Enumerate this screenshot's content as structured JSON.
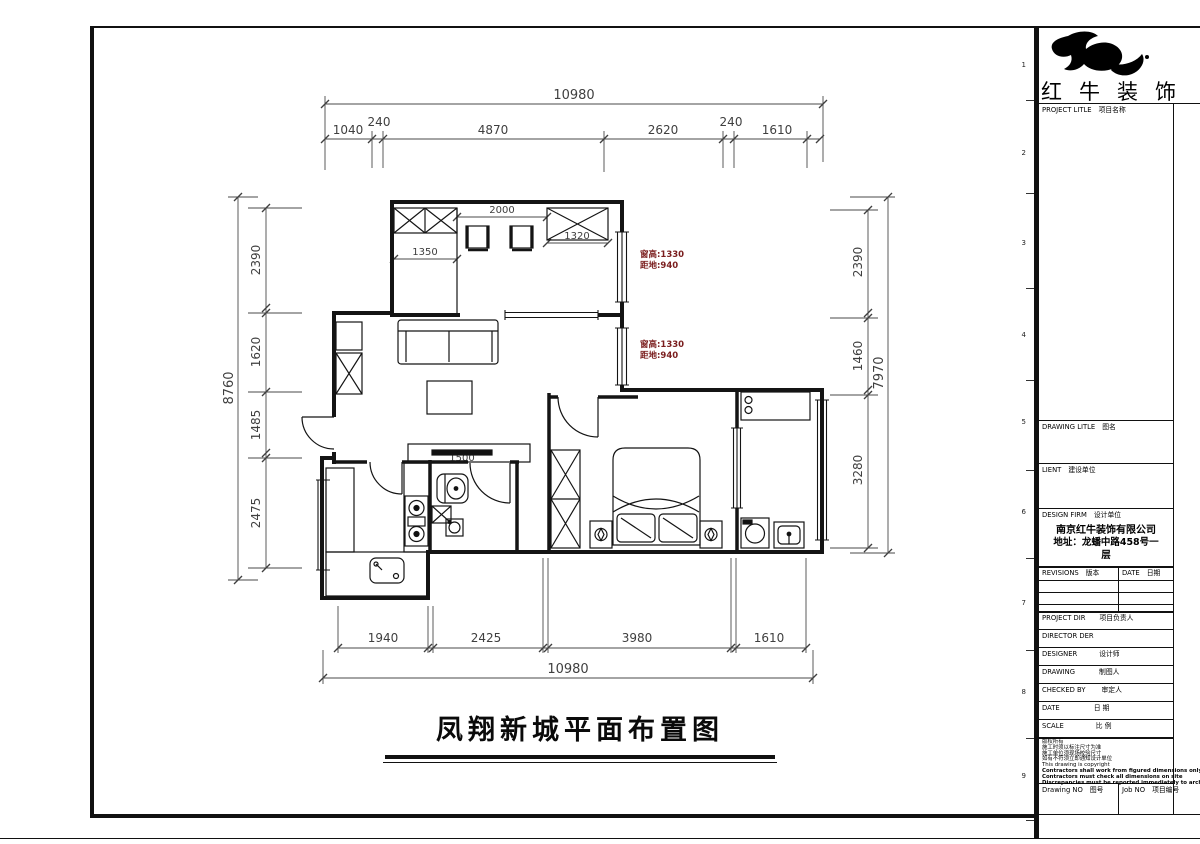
{
  "brand": {
    "name": "红牛装饰"
  },
  "row_markers": [
    "1",
    "2",
    "3",
    "4",
    "5",
    "6",
    "7",
    "8",
    "9"
  ],
  "title_block": {
    "project_title_en": "PROJECT LITLE",
    "project_title_cn": "项目名称",
    "drawing_title_en": "DRAWING LITLE",
    "drawing_title_cn": "图名",
    "client_en": "LIENT",
    "client_cn": "建设单位",
    "design_firm_en": "DESIGN FIRM",
    "design_firm_cn": "设计单位",
    "firm_name": "南京红牛装饰有限公司",
    "firm_address_line1": "地址：龙蟠中路458号一",
    "firm_address_line2": "层",
    "revisions_en": "REVISIONS",
    "revisions_cn": "版本",
    "date_en": "DATE",
    "date_cn": "日期",
    "rows": [
      {
        "en": "PROJECT DIR",
        "cn": "项目负责人"
      },
      {
        "en": "DIRECTOR DER",
        "cn": ""
      },
      {
        "en": "DESIGNER",
        "cn": "设计师"
      },
      {
        "en": "DRAWING",
        "cn": "制图人"
      },
      {
        "en": "CHECKED BY",
        "cn": "审定人"
      },
      {
        "en": "DATE",
        "cn": "日 期"
      },
      {
        "en": "SCALE",
        "cn": "比 例"
      }
    ],
    "notes": [
      "版权所有",
      "施工时须以标注尺寸为准",
      "施工单位须现场校验尺寸",
      "如有不符须立即通知设计单位",
      "This drawing is copyright",
      "Contractors shall work from figured dimensions only",
      "Contractors must check all dimensions on site",
      "Discrepancies must be reported immediately to architects"
    ],
    "drawing_no_en": "Drawing NO",
    "drawing_no_cn": "图号",
    "job_no_en": "Job NO",
    "job_no_cn": "项目编号"
  },
  "plan": {
    "title": "凤翔新城平面布置图",
    "colors": {
      "annotation_red": "#7a1d1d",
      "line_black": "#1a1a1a"
    },
    "window_notes": {
      "upper": {
        "line1": "窗高:1330",
        "line2": "距地:940"
      },
      "lower": {
        "line1": "窗高:1330",
        "line2": "距地:940"
      }
    },
    "inner_dims": {
      "wardrobe_gap": "2000",
      "closet": "1350",
      "wardrobe_right": "1320",
      "tv_cabinet": "1500"
    },
    "dims": {
      "top": {
        "overall": "10980",
        "segments": [
          "1040",
          "240",
          "4870",
          "2620",
          "240",
          "1610"
        ]
      },
      "bottom": {
        "overall": "10980",
        "segments": [
          "1940",
          "2425",
          "3980",
          "1610"
        ]
      },
      "left": {
        "overall": "8760",
        "segments": [
          "2390",
          "1620",
          "1485",
          "2475"
        ]
      },
      "right": {
        "overall": "7970",
        "segments": [
          "2390",
          "1460",
          "3280"
        ]
      }
    }
  }
}
